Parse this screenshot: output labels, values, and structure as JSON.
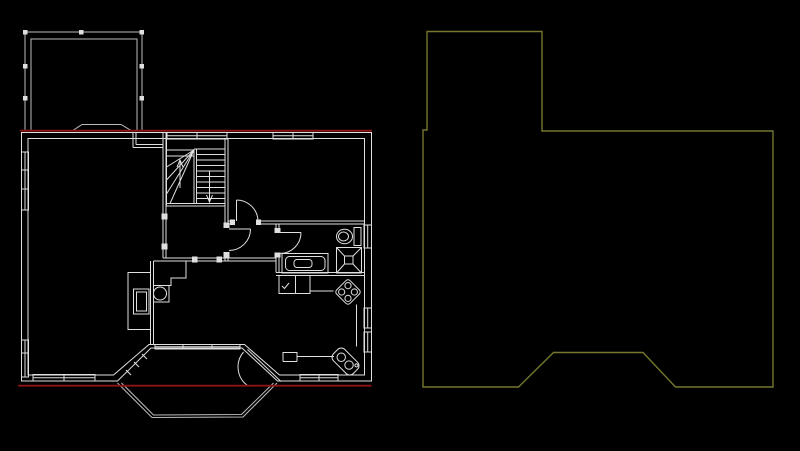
{
  "app": {
    "type": "cad-viewport",
    "background": "#000000"
  },
  "colors": {
    "canvas_bg": "#000000",
    "wall_line": "#dfdfdf",
    "dim_line": "#bcbcbc",
    "red_overlay": "#8c1416",
    "olive_outline": "#76762f"
  },
  "left_view": {
    "kind": "floor-plan-drawing",
    "fixtures": [
      "deck",
      "staircase",
      "bedroom-door",
      "hall-door",
      "bathroom-door",
      "toilet",
      "shower",
      "bathtub",
      "fireplace",
      "stove",
      "corner-sink",
      "kitchen-counter",
      "bay-porch",
      "porch-door"
    ]
  },
  "overlay": {
    "red_top": {
      "x1": 20,
      "y1": 130.7,
      "x2": 372,
      "y2": 130.7
    },
    "red_bottom": {
      "x1": 18,
      "y1": 385.7,
      "x2": 371.5,
      "y2": 385.7
    }
  },
  "right_view": {
    "kind": "floor-outline-drawing",
    "outline_points": "427,31.5 542,31.5 542,131 773,131 773,387 675.5,387 643,352.5 553.5,352.5 518.5,387 423,387 423,130 427,130"
  }
}
